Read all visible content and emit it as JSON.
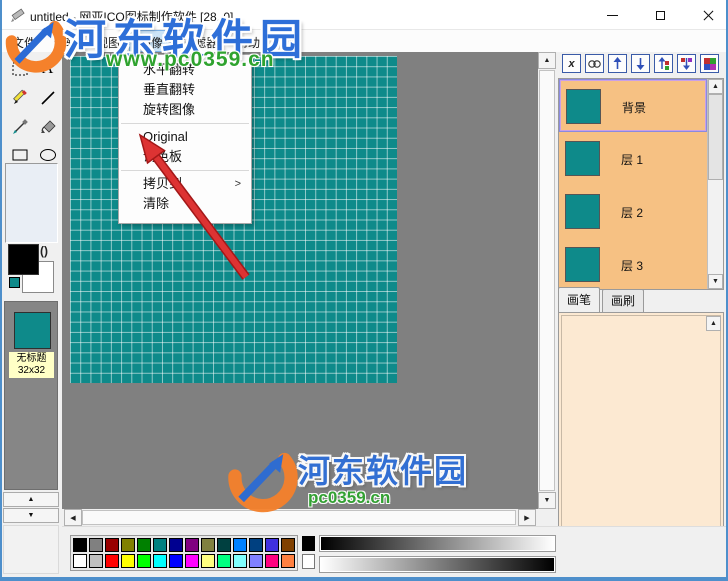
{
  "window": {
    "title": "untitled - 网亚ICO图标制作软件 [28, 0]"
  },
  "menu_bar": {
    "items": [
      {
        "label": "文件"
      },
      {
        "label": "编辑"
      },
      {
        "label": "视图"
      },
      {
        "label": "图像",
        "active": true
      },
      {
        "label": "过滤器"
      },
      {
        "label": "帮助"
      }
    ]
  },
  "context_menu": {
    "items": [
      {
        "label": "水平翻转"
      },
      {
        "label": "垂直翻转"
      },
      {
        "label": "旋转图像"
      },
      {
        "label": "Original"
      },
      {
        "label": "调色板"
      },
      {
        "label": "拷贝到",
        "submenu": true
      },
      {
        "label": "清除"
      }
    ],
    "submenu_arrow": ">"
  },
  "left_toolbar": {
    "tools": [
      "rect-select",
      "text",
      "pencil",
      "line",
      "eyedropper",
      "fill",
      "rectangle",
      "ellipse"
    ],
    "icon_list_item": {
      "name": "无标题",
      "size": "32x32"
    }
  },
  "canvas": {
    "grid": "32x32",
    "fill_color": "#0E8A8A"
  },
  "right_panel": {
    "layers": [
      {
        "label": "背景",
        "selected": true
      },
      {
        "label": "层 1",
        "selected": false
      },
      {
        "label": "层 2",
        "selected": false
      },
      {
        "label": "层 3",
        "selected": false
      }
    ],
    "tabs": [
      {
        "label": "画笔",
        "active": true
      },
      {
        "label": "画刷",
        "active": false
      }
    ],
    "rgb": {
      "r": "0",
      "g": "0",
      "b": "0"
    },
    "hex": "000000"
  },
  "bottom_bar": {
    "palette_row1": [
      "#000000",
      "#808080",
      "#980000",
      "#808000",
      "#008000",
      "#008080",
      "#000090",
      "#800080",
      "#808040",
      "#004040",
      "#0080FF",
      "#004080",
      "#4030E0",
      "#804000"
    ],
    "palette_row2": [
      "#FFFFFF",
      "#C0C0C0",
      "#FF0000",
      "#FFFF00",
      "#00FF00",
      "#00FFFF",
      "#0000FF",
      "#FF00FF",
      "#FFFF80",
      "#00FF80",
      "#80FFFF",
      "#8080FF",
      "#FF0080",
      "#FF8040"
    ]
  },
  "watermark": {
    "site_name": "河东软件园",
    "site_url": "www.pc0359.cn",
    "site_url_short": "pc0359.cn"
  }
}
